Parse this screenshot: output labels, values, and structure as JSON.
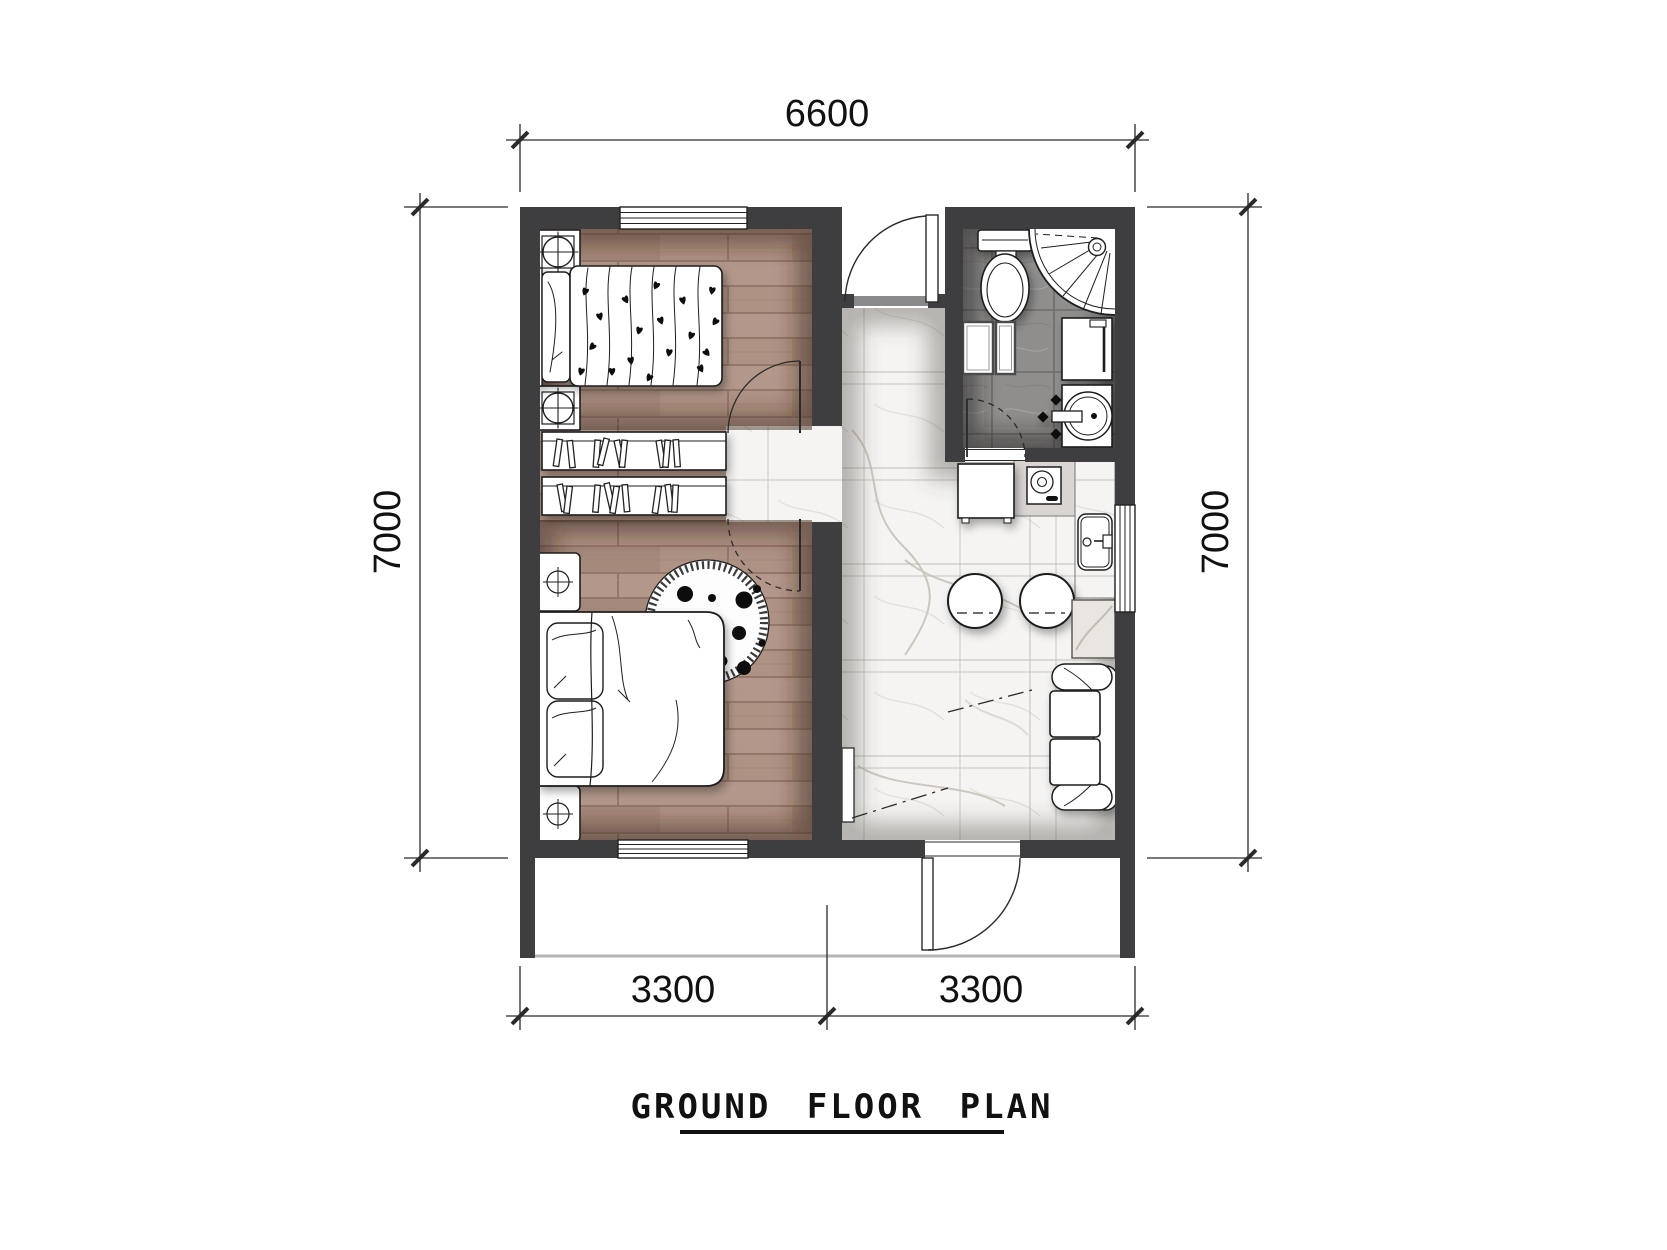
{
  "title": "GROUND FLOOR PLAN",
  "dimensions": {
    "top": "6600",
    "left": "7000",
    "right": "7000",
    "bottom_left": "3300",
    "bottom_right": "3300"
  },
  "colors": {
    "wall": "#3e3e40",
    "wood_floor": "#ac9183",
    "bath_tile": "#8f8d8b",
    "marble_floor": "#f5f4f2",
    "line": "#1c1c1c"
  },
  "fixtures": [
    "single-bed",
    "double-bed",
    "nightstand-lamp",
    "bookshelf",
    "round-rug",
    "entry-door",
    "bedroom-door",
    "bathroom-door",
    "toilet",
    "corner-shower",
    "washing-machine",
    "washbasin",
    "storage-cabinets",
    "kitchen-cabinet",
    "stove",
    "kitchen-sink",
    "bar-stool",
    "counter",
    "side-table",
    "sofa",
    "window"
  ]
}
